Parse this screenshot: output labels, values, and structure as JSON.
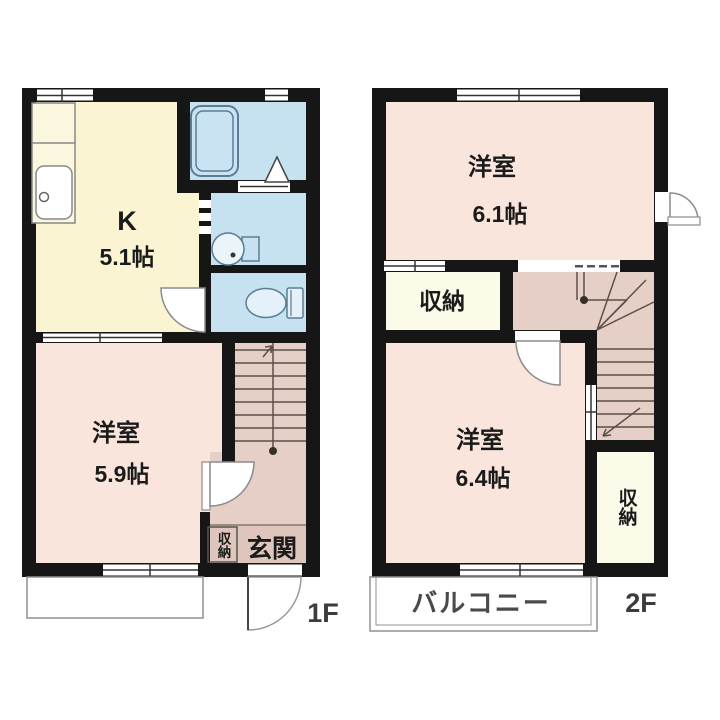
{
  "floor1": {
    "floor_label": "1F",
    "kitchen": {
      "name": "K",
      "area": "5.1帖"
    },
    "western_room": {
      "name": "洋室",
      "area": "5.9帖"
    },
    "entrance": {
      "label": "玄関"
    },
    "closet": {
      "label": "収納"
    }
  },
  "floor2": {
    "floor_label": "2F",
    "western_room_upper": {
      "name": "洋室",
      "area": "6.1帖"
    },
    "western_room_lower": {
      "name": "洋室",
      "area": "6.4帖"
    },
    "closet_upper": {
      "label": "収納"
    },
    "closet_lower": {
      "label": "収納"
    },
    "balcony": {
      "label": "バルコニー"
    }
  },
  "colors": {
    "wall": "#161616",
    "kitchen": "#FAF4D3",
    "water_area": "#C6E2F1",
    "room": "#F9E5DC",
    "hall_stairs": "#E6CFC6",
    "entrance": "#DFC6BC",
    "closet": "#FCFAE9",
    "fixture_outline": "#5c7c94"
  }
}
